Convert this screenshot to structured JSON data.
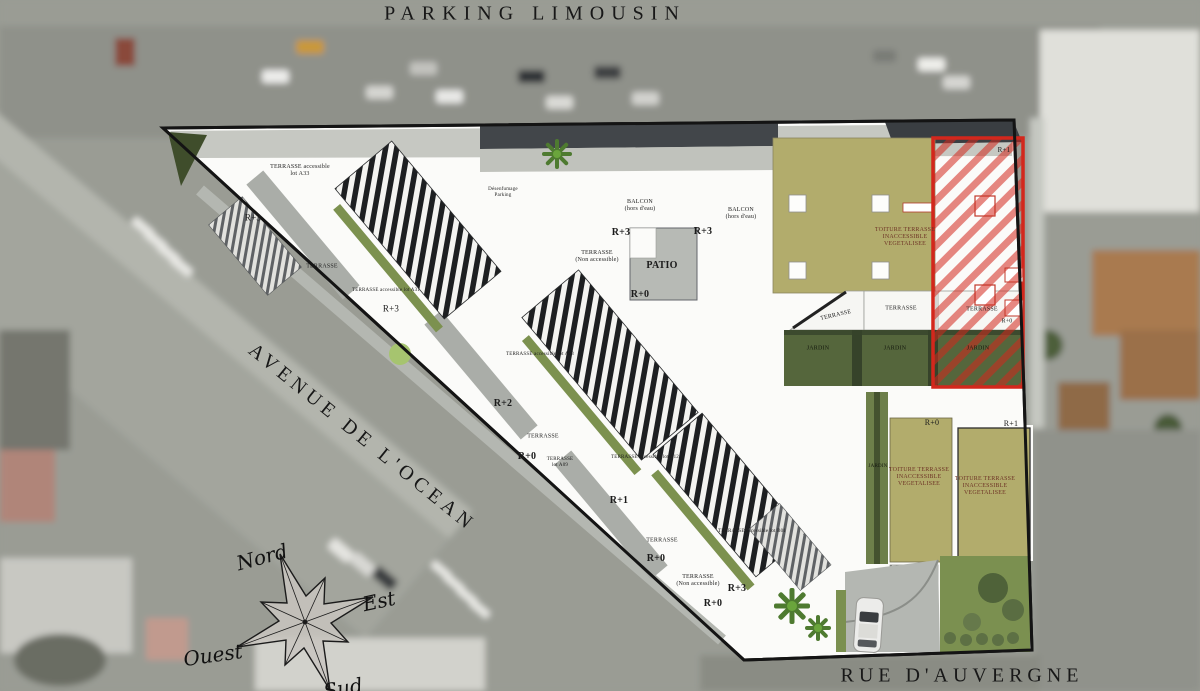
{
  "title": "PARKING LIMOUSIN",
  "streets": {
    "avenue": "AVENUE DE L'OCEAN",
    "rue": "RUE D'AUVERGNE"
  },
  "compass": {
    "north": "Nord",
    "east": "Est",
    "west": "Ouest",
    "south": "Sud"
  },
  "colors": {
    "highlight_red": "#d3271c",
    "roof_olive": "#b2ac6c",
    "garden_green": "#55663c",
    "lawn_green": "#7b9050",
    "plan_white": "#fbfbf9"
  },
  "icons": {
    "compass_rose": "compass-rose-icon",
    "car": "car-icon",
    "palm_tree": "palm-tree-icon"
  },
  "plan_labels": [
    "TERRASSE accessible\nlot A33",
    "R+3",
    "TERRASSE",
    "TERRASSE accessible lot A31",
    "R+3",
    "Désenfumage\nParking",
    "BALCON\n(hors d'eau)",
    "BALCON\n(hors d'eau)",
    "R+3",
    "R+3",
    "TERRASSE\n(Non accessible)",
    "PATIO",
    "R+0",
    "TERRASSE accessible lot A23",
    "R+2",
    "TERRASSE",
    "R+0",
    "TERRASSE\nlot A09",
    "TERRASSE accessible lot A12",
    "R+1",
    "TERRASSE accessible lot B01",
    "TERRASSE",
    "R+0",
    "TERRASSE\n(Non accessible)",
    "R+3",
    "R+0",
    "TOITURE TERRASSE\nINACCESSIBLE\nVEGETALISEE",
    "TERRASSE",
    "TERRASSE",
    "TERRASSE",
    "R+0",
    "JARDIN",
    "JARDIN",
    "JARDIN",
    "R+1",
    "JARDIN",
    "R+0",
    "R+1",
    "TOITURE TERRASSE\nINACCESSIBLE\nVEGETALISEE",
    "TOITURE TERRASSE\nINACCESSIBLE\nVEGETALISEE"
  ]
}
